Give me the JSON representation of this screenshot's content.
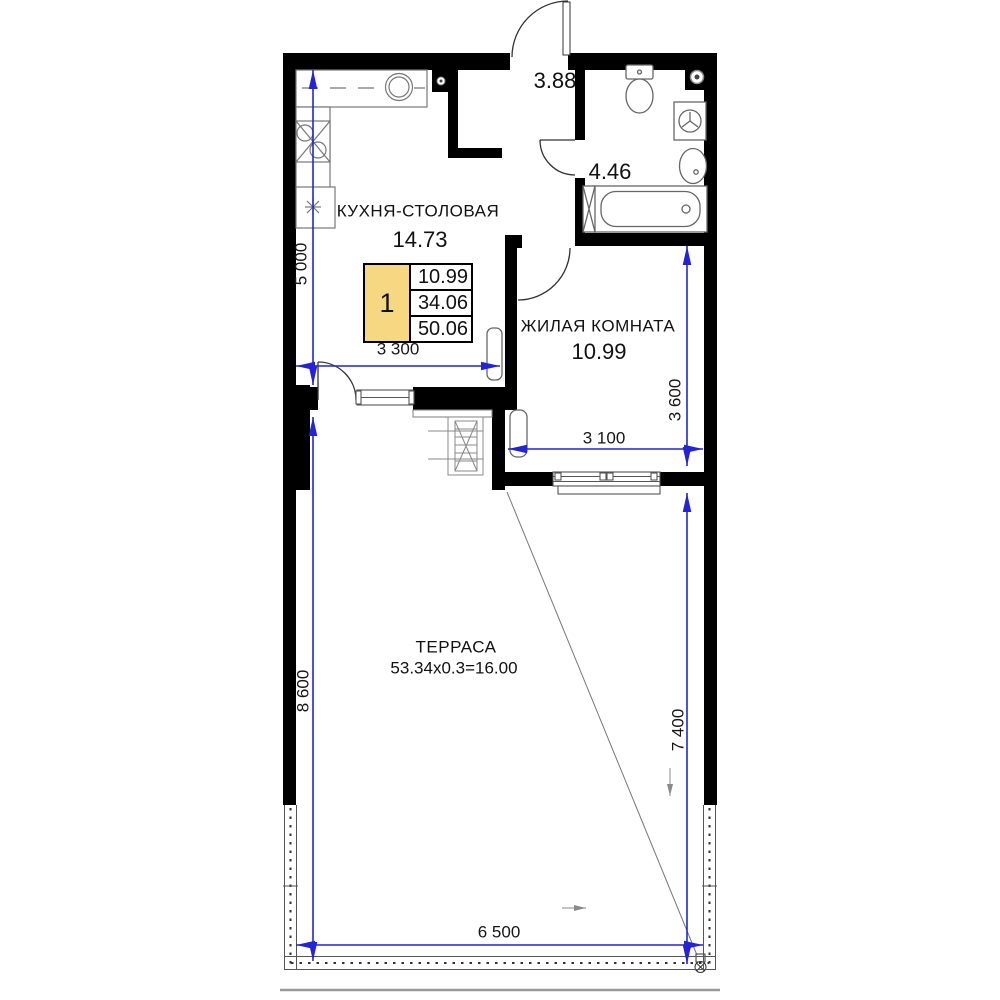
{
  "rooms": {
    "kitchen": {
      "label": "КУХНЯ-СТОЛОВАЯ",
      "area": "14.73"
    },
    "living": {
      "label": "ЖИЛАЯ КОМНАТА",
      "area": "10.99"
    },
    "terrace": {
      "label": "ТЕРРАСА",
      "area_calc": "53.34x0.3=16.00"
    },
    "hallway": {
      "area": "3.88"
    },
    "bathroom": {
      "area": "4.46"
    }
  },
  "info_box": {
    "rooms_count": "1",
    "living_area": "10.99",
    "apartment_area": "34.06",
    "total_area": "50.06"
  },
  "dimensions": {
    "kitchen_height": "5 000",
    "kitchen_width": "3 300",
    "living_height": "3 600",
    "living_width": "3 100",
    "terrace_left_height": "8 600",
    "terrace_right_height": "7 400",
    "terrace_width": "6 500"
  },
  "colors": {
    "wall": "#000000",
    "dimension_line": "#2424d6",
    "info_box_fill": "#f6d782",
    "fixture_line": "#666666",
    "text": "#111111"
  }
}
